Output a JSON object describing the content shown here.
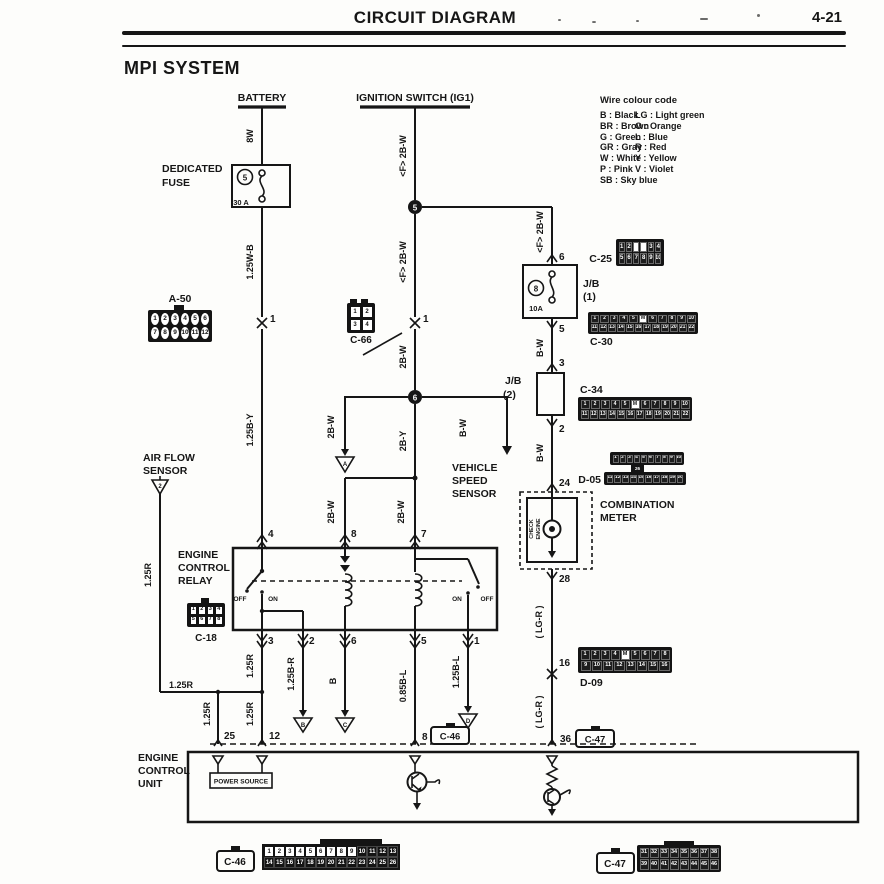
{
  "page": {
    "header_title": "CIRCUIT DIAGRAM",
    "page_number": "4-21",
    "system_title": "MPI SYSTEM"
  },
  "legend": {
    "title": "Wire colour code",
    "left": [
      "B : Black",
      "BR : Brown",
      "G : Green",
      "GR : Gray",
      "W : White",
      "P : Pink",
      "SB : Sky blue"
    ],
    "right": [
      "LG : Light green",
      "O : Orange",
      "L : Blue",
      "R : Red",
      "Y : Yellow",
      "V : Violet"
    ]
  },
  "labels": {
    "battery": "BATTERY",
    "ignition_switch": "IGNITION SWITCH (IG1)",
    "dedicated_fuse_1": "DEDICATED",
    "dedicated_fuse_2": "FUSE",
    "fuse_battery_id": "5",
    "fuse_battery_rating": "30 A",
    "jb": "J/B",
    "jb1_num": "(1)",
    "jb2_num": "(2)",
    "fuse_jb_id": "8",
    "fuse_jb_rating": "10A",
    "air_flow_1": "AIR FLOW",
    "air_flow_2": "SENSOR",
    "vss_1": "VEHICLE",
    "vss_2": "SPEED",
    "vss_3": "SENSOR",
    "relay_1": "ENGINE",
    "relay_2": "CONTROL",
    "relay_3": "RELAY",
    "comb_meter_1": "COMBINATION",
    "comb_meter_2": "METER",
    "check_1": "CHECK",
    "check_2": "ENGINE",
    "ecu_1": "ENGINE",
    "ecu_2": "CONTROL",
    "ecu_3": "UNIT",
    "power_source": "POWER SOURCE",
    "off": "OFF",
    "on": "ON"
  },
  "wires": {
    "w8w": "8W",
    "f2bw": "<F> 2B-W",
    "w125wb": "1.25W-B",
    "w125by": "1.25B-Y",
    "w2bw": "2B-W",
    "w2by": "2B-Y",
    "bw": "B-W",
    "lgr": "( LG-R )",
    "w125r": "1.25R",
    "w125br": "1.25B-R",
    "wb": "B",
    "w085bl": "0.85B-L",
    "w125bl": "1.25B-L"
  },
  "pins": {
    "p1": "1",
    "p2": "2",
    "p3": "3",
    "p4": "4",
    "p5": "5",
    "p6": "6",
    "p7": "7",
    "p8": "8",
    "p12": "12",
    "p16": "16",
    "p24": "24",
    "p25": "25",
    "p28": "28",
    "p36": "36"
  },
  "nodes": {
    "n5": "5",
    "n6": "6"
  },
  "grounds": {
    "airflow": "2",
    "a": "A",
    "b": "B",
    "c": "C",
    "d": "D"
  },
  "connectors": {
    "a50": {
      "label": "A-50",
      "rows": [
        [
          "1",
          "2",
          "3",
          "4",
          "5",
          "6"
        ],
        [
          "7",
          "8",
          "9",
          "10",
          "11",
          "12"
        ]
      ]
    },
    "c66": {
      "label": "C-66",
      "rows": [
        [
          "1",
          "2"
        ],
        [
          "3",
          "4"
        ]
      ]
    },
    "c18": {
      "label": "C-18",
      "rows": [
        [
          "1",
          "2",
          "3",
          "4"
        ],
        [
          "5",
          "6",
          "7",
          "8"
        ]
      ]
    },
    "c25": {
      "label": "C-25",
      "rows": [
        [
          "1",
          "2",
          "",
          "",
          "3",
          "4"
        ],
        [
          "5",
          "6",
          "7",
          "8",
          "9",
          "10"
        ]
      ]
    },
    "c30": {
      "label": "C-30",
      "rows": [
        [
          "1",
          "2",
          "3",
          "4",
          "5",
          "M",
          "6",
          "7",
          "8",
          "9",
          "10"
        ],
        [
          "11",
          "12",
          "13",
          "14",
          "15",
          "16",
          "17",
          "18",
          "19",
          "20",
          "21",
          "22"
        ]
      ]
    },
    "c34": {
      "label": "C-34",
      "rows": [
        [
          "1",
          "2",
          "3",
          "4",
          "5",
          "M",
          "6",
          "7",
          "8",
          "9",
          "10"
        ],
        [
          "11",
          "12",
          "13",
          "14",
          "15",
          "16",
          "17",
          "18",
          "19",
          "20",
          "21",
          "22"
        ]
      ]
    },
    "d05": {
      "label": "D-05",
      "center": "26",
      "rows_top": [
        [
          "1",
          "2",
          "3",
          "4",
          "5",
          "6",
          "7",
          "8",
          "9",
          "10"
        ]
      ],
      "rows_bottom": [
        [
          "11",
          "12",
          "13",
          "14",
          "15",
          "16",
          "17",
          "18",
          "19",
          "20"
        ]
      ]
    },
    "d09": {
      "label": "D-09",
      "rows": [
        [
          "1",
          "2",
          "3",
          "4",
          "M",
          "5",
          "6",
          "7",
          "8"
        ],
        [
          "9",
          "10",
          "11",
          "12",
          "13",
          "14",
          "15",
          "16"
        ]
      ]
    },
    "c46_box": {
      "label": "C-46"
    },
    "c47_box": {
      "label": "C-47"
    },
    "c46_strip": {
      "rows": [
        [
          "1",
          "2",
          "3",
          "4",
          "5",
          "6",
          "7",
          "8",
          "9",
          "10",
          "11",
          "12",
          "13"
        ],
        [
          "14",
          "15",
          "16",
          "17",
          "18",
          "19",
          "20",
          "21",
          "22",
          "23",
          "24",
          "25",
          "26"
        ]
      ]
    },
    "c47_strip": {
      "rows": [
        [
          "31",
          "32",
          "33",
          "34",
          "35",
          "36",
          "37",
          "38"
        ],
        [
          "39",
          "40",
          "41",
          "42",
          "43",
          "44",
          "45",
          "46"
        ]
      ]
    }
  }
}
